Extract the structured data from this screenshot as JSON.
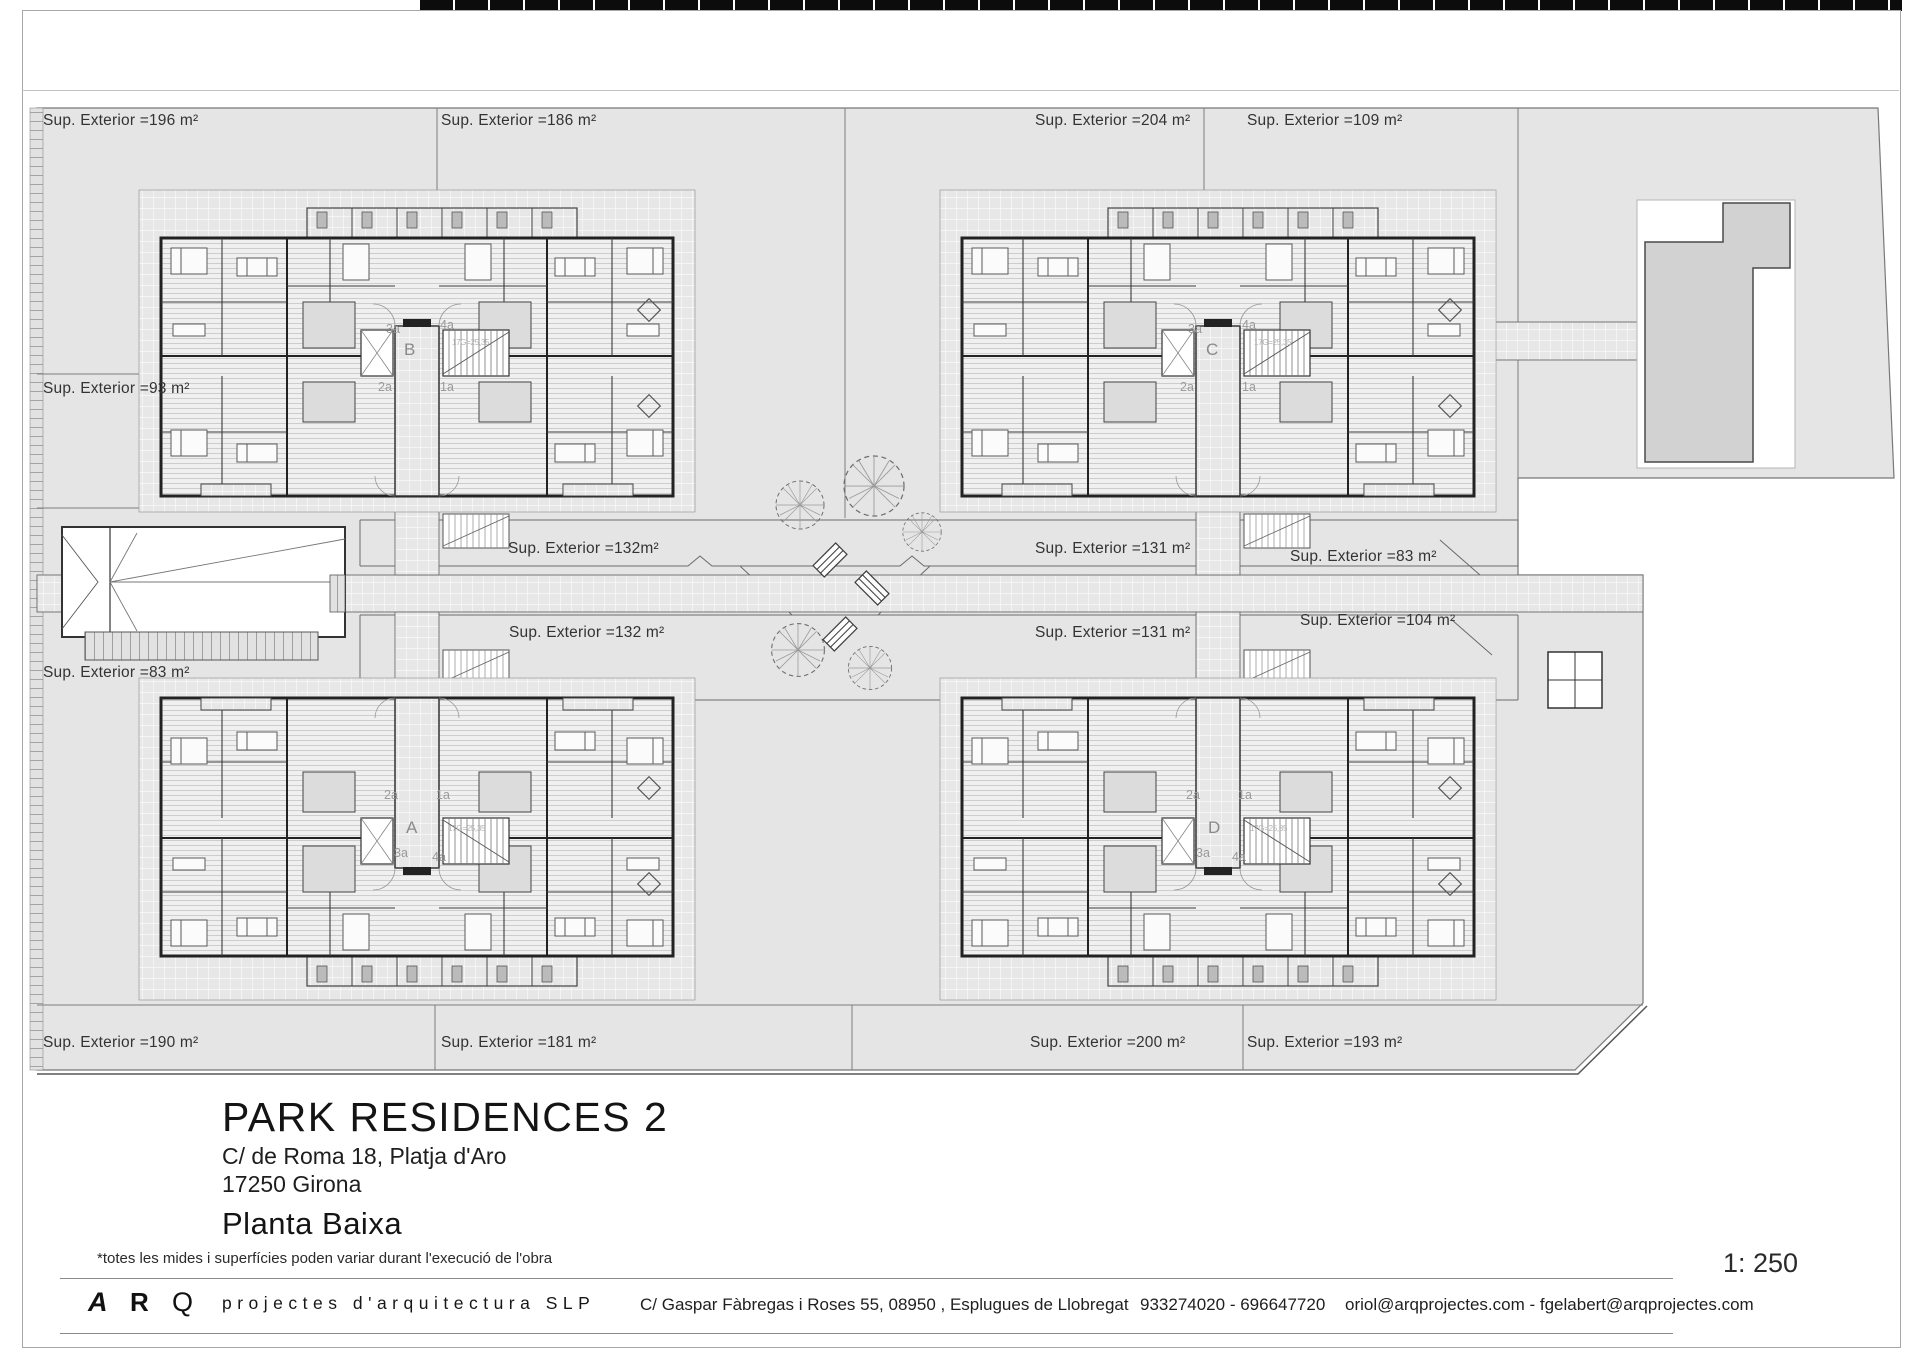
{
  "sheet": {
    "title": "PARK RESIDENCES 2",
    "address_line1": "C/ de Roma 18, Platja d'Aro",
    "address_line2": "17250 Girona",
    "plan_name": "Planta Baixa",
    "disclaimer": "*totes les mides i superfícies poden variar durant l'execució de l'obra",
    "scale_label": "1: 250"
  },
  "footer": {
    "logo_a": "A",
    "logo_r": "R",
    "logo_q": "Q",
    "studio": "projectes d'arquitectura SLP",
    "address": "C/ Gaspar Fàbregas i Roses 55, 08950 , Esplugues de Llobregat",
    "phones": "933274020 - 696647720",
    "emails": "oriol@arqprojectes.com - fgelabert@arqprojectes.com"
  },
  "labels": {
    "sup": [
      "Sup. Exterior =196 m²",
      "Sup. Exterior =186 m²",
      "Sup. Exterior =204 m²",
      "Sup. Exterior =109 m²",
      "Sup. Exterior =93 m²",
      "Sup. Exterior =83 m²",
      "Sup. Exterior =132m²",
      "Sup. Exterior =131 m²",
      "Sup. Exterior =83 m²",
      "Sup. Exterior =132 m²",
      "Sup. Exterior =131 m²",
      "Sup. Exterior =104 m²",
      "Sup. Exterior =190 m²",
      "Sup. Exterior =181 m²",
      "Sup. Exterior =200 m²",
      "Sup. Exterior =193 m²"
    ]
  },
  "buildings": {
    "letters": [
      "B",
      "C",
      "A",
      "D"
    ],
    "units": [
      "3a",
      "4a",
      "2a",
      "1a",
      "3a",
      "4a",
      "2a",
      "1a",
      "2a",
      "1a",
      "3a",
      "4a",
      "2a",
      "1a",
      "3a",
      "4a"
    ],
    "stair_note": "17G=25,35"
  },
  "colors": {
    "site_gray": "#e5e5e5",
    "wall_dark": "#222222",
    "pool_gray": "#d2d2d2"
  }
}
